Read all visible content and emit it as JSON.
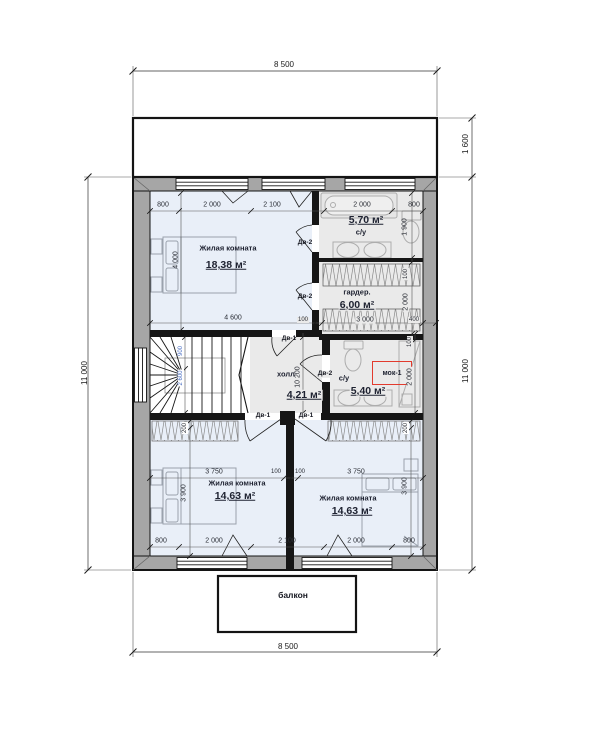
{
  "colors": {
    "bedroom_fill": "#e9eff8",
    "wet_room_fill": "#eaeaea",
    "wall_grey": "#a6a6a6",
    "wall_dark": "#161616",
    "tag_red": "#e23b2e",
    "stair_dim_blue": "#4a6fc4"
  },
  "rooms": {
    "living1": {
      "name": "Жилая комната",
      "area": "18,38 м²"
    },
    "bath1": {
      "name": "с/у",
      "area": "5,70 м²"
    },
    "wardrobe": {
      "name": "гардер.",
      "area": "6,00 м²"
    },
    "hall": {
      "name": "холл",
      "area": "4,21 м²"
    },
    "bath2": {
      "name": "с/у",
      "area": "5,40 м²",
      "tag": "мок-1"
    },
    "living2": {
      "name": "Жилая комната",
      "area": "14,63 м²"
    },
    "living3": {
      "name": "Жилая комната",
      "area": "14,63 м²"
    },
    "balcony": {
      "name": "балкон"
    }
  },
  "door_types": {
    "dv1": "Дв-1",
    "dv2": "Дв-2"
  },
  "outer_dims": {
    "top": "8 500",
    "bottom": "8 500",
    "left": "11 000",
    "right": "11 000",
    "terrace_depth": "1 600"
  },
  "dims": {
    "top_row": [
      "800",
      "2 000",
      "2 100",
      "2 000",
      "800"
    ],
    "bottom_row": [
      "800",
      "2 000",
      "2 100",
      "2 000",
      "800"
    ],
    "mid_row": [
      "3 750",
      "100",
      "100",
      "3 750"
    ],
    "living1_width": "4 600",
    "living1_height": "4 000",
    "bath1_height": "1 900",
    "wardrobe_wall": "100",
    "wardrobe_height": "2 000",
    "wardrobe_row": [
      "100",
      "3 000",
      "400"
    ],
    "hall_height": "10 200",
    "bath2_wall": "100",
    "bath2_height": "2 000",
    "living2_height": "3 900",
    "living2_closet": "200",
    "living3_height": "3 900",
    "living3_closet": "200",
    "stair_dims": [
      "900",
      "2 600"
    ]
  }
}
